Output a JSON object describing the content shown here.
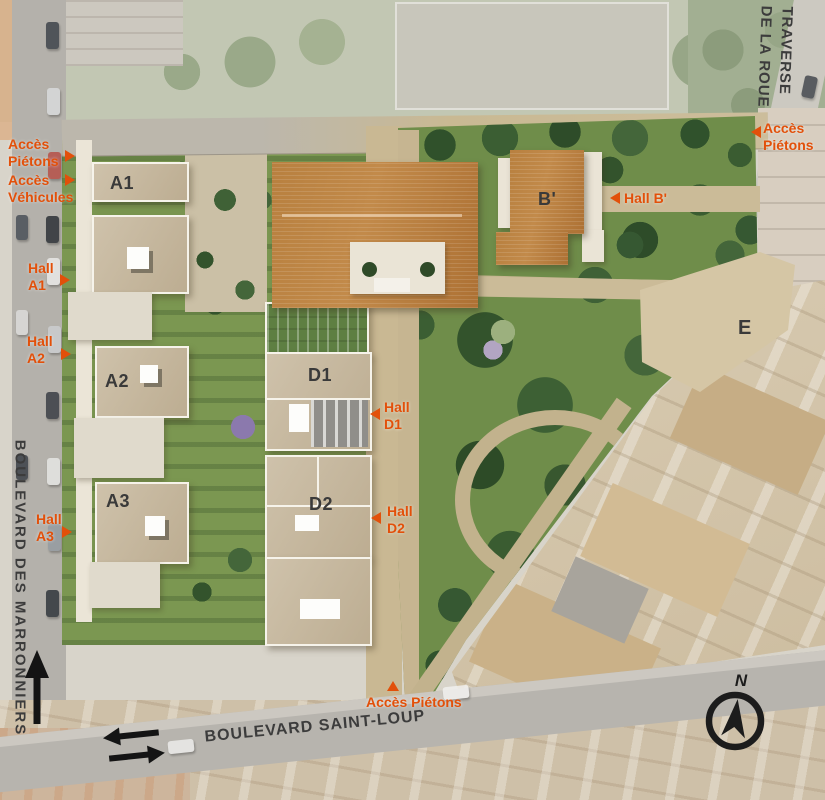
{
  "colors": {
    "accent_orange": "#E2500A",
    "building_label": "#3A3A3A",
    "road_label": "#3C3C3C"
  },
  "roads": {
    "west": "BOULEVARD DES MARRONNIERS",
    "south": "BOULEVARD SAINT-LOUP",
    "northeast_line1": "TRAVERSE",
    "northeast_line2": "DE LA ROUE"
  },
  "buildings": {
    "a1": "A1",
    "a2": "A2",
    "a3": "A3",
    "b": "B'",
    "d1": "D1",
    "d2": "D2",
    "e": "E"
  },
  "access": {
    "pedestrian_nw": {
      "line1": "Accès",
      "line2": "Piétons"
    },
    "vehicle_w": {
      "line1": "Accès",
      "line2": "Véhicules"
    },
    "hall_a1": {
      "line1": "Hall",
      "line2": "A1"
    },
    "hall_a2": {
      "line1": "Hall",
      "line2": "A2"
    },
    "hall_a3": {
      "line1": "Hall",
      "line2": "A3"
    },
    "hall_b": "Hall B'",
    "hall_d1": {
      "line1": "Hall",
      "line2": "D1"
    },
    "hall_d2": {
      "line1": "Hall",
      "line2": "D2"
    },
    "pedestrian_ne": {
      "line1": "Accès",
      "line2": "Piétons"
    },
    "pedestrian_s": "Accès Piétons"
  },
  "compass": {
    "north": "N"
  }
}
